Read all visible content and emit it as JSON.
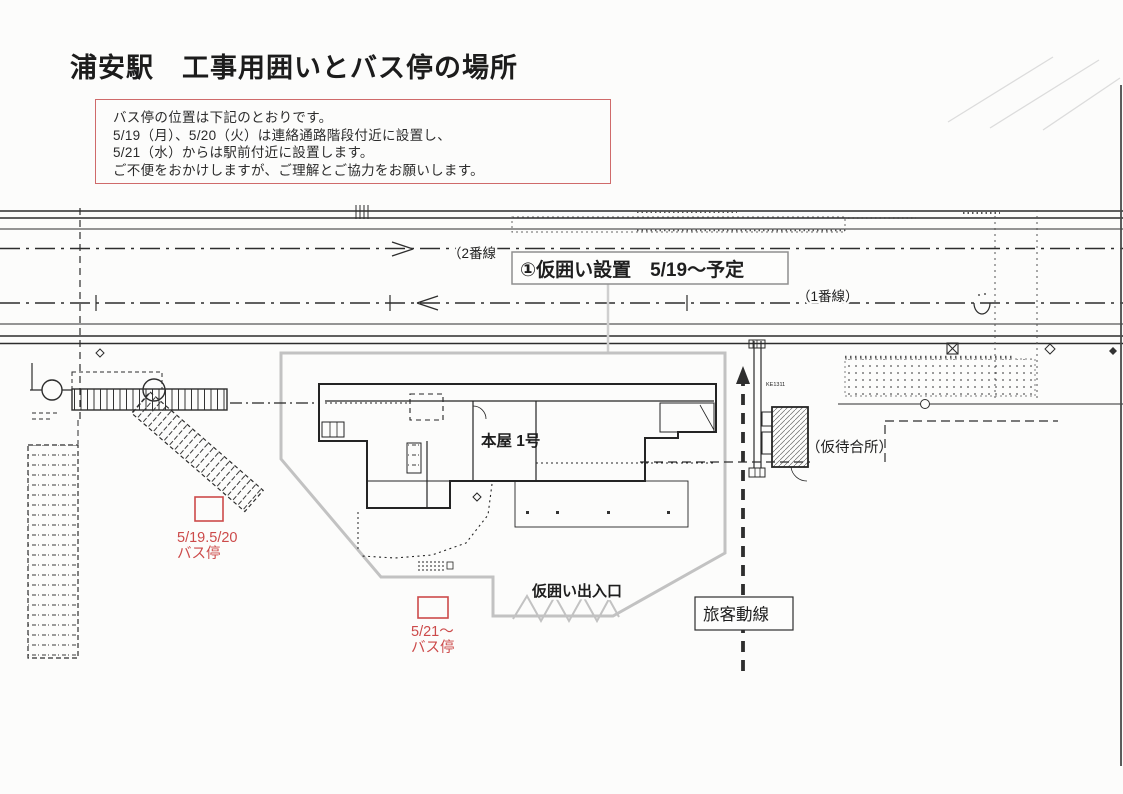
{
  "title": "浦安駅　工事用囲いとバス停の場所",
  "notice": {
    "lines": [
      "バス停の位置は下記のとおりです。",
      "5/19（月）、5/20（火）は連絡通路階段付近に設置し、",
      "5/21（水）からは駅前付近に設置します。",
      "ご不便をおかけしますが、ご理解とご協力をお願いします。"
    ]
  },
  "diagram": {
    "callout_label": "①仮囲い設置　5/19～予定",
    "track2_label": "（2番線",
    "track1_label": "（1番線）",
    "building_label": "本屋 1号",
    "waiting_area_label": "（仮待合所）",
    "gate_label": "仮囲い出入口",
    "flow_label": "旅客動線",
    "equipment_code": "KE1311",
    "bus_stop_early": {
      "dates": "5/19.5/20",
      "label": "バス停"
    },
    "bus_stop_late": {
      "dates": "5/21～",
      "label": "バス停"
    }
  },
  "colors": {
    "red": "#cc4a4a",
    "fence": "#c2c2c2",
    "ink": "#262626"
  }
}
